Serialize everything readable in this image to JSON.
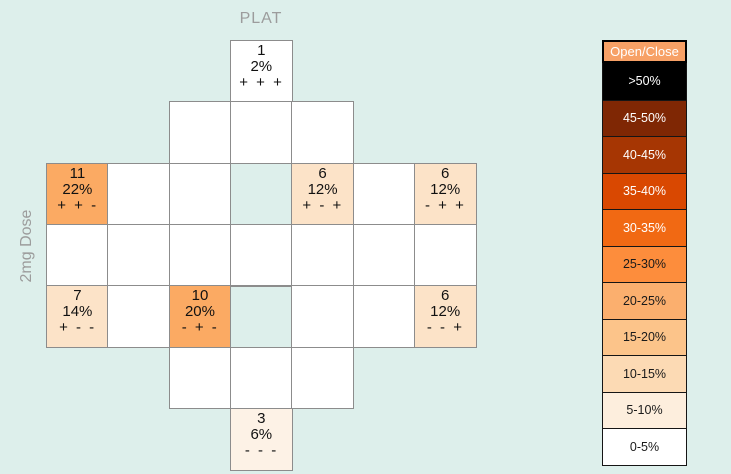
{
  "background_color": "#ddefeb",
  "grid_border_color": "#8c8c8c",
  "labels": {
    "top_axis": "PLAT",
    "left_axis": "2mg Dose"
  },
  "chart_data": {
    "type": "heatmap",
    "title": "PLAT",
    "ylabel": "2mg Dose",
    "legend_position": "right",
    "legend_title": "Open/Close",
    "grid": {
      "rows": 7,
      "cols": 7,
      "origin_x": 46,
      "origin_y": 40,
      "cell_size": 61.3
    },
    "cells": [
      {
        "row": 0,
        "col": 3,
        "count": "1",
        "pct": "2%",
        "signs": "+ + +",
        "fill": "#ffffff"
      },
      {
        "row": 1,
        "col": 2,
        "fill": "#ffffff"
      },
      {
        "row": 1,
        "col": 3,
        "fill": "#ffffff"
      },
      {
        "row": 1,
        "col": 4,
        "fill": "#ffffff"
      },
      {
        "row": 2,
        "col": 0,
        "count": "11",
        "pct": "22%",
        "signs": "+ + -",
        "fill": "#fbaa63"
      },
      {
        "row": 2,
        "col": 1,
        "fill": "#ffffff"
      },
      {
        "row": 2,
        "col": 2,
        "fill": "#ffffff"
      },
      {
        "row": 2,
        "col": 3,
        "fill": "none"
      },
      {
        "row": 2,
        "col": 4,
        "count": "6",
        "pct": "12%",
        "signs": "+ - +",
        "fill": "#fce3c8"
      },
      {
        "row": 2,
        "col": 5,
        "fill": "#ffffff"
      },
      {
        "row": 2,
        "col": 6,
        "count": "6",
        "pct": "12%",
        "signs": "- + +",
        "fill": "#fce3c8"
      },
      {
        "row": 3,
        "col": 0,
        "fill": "#ffffff"
      },
      {
        "row": 3,
        "col": 1,
        "fill": "#ffffff"
      },
      {
        "row": 3,
        "col": 2,
        "fill": "#ffffff"
      },
      {
        "row": 3,
        "col": 3,
        "fill": "#ffffff"
      },
      {
        "row": 3,
        "col": 4,
        "fill": "#ffffff"
      },
      {
        "row": 3,
        "col": 5,
        "fill": "#ffffff"
      },
      {
        "row": 3,
        "col": 6,
        "fill": "#ffffff"
      },
      {
        "row": 4,
        "col": 0,
        "count": "7",
        "pct": "14%",
        "signs": "+ - -",
        "fill": "#fce3c8"
      },
      {
        "row": 4,
        "col": 1,
        "fill": "#ffffff"
      },
      {
        "row": 4,
        "col": 2,
        "count": "10",
        "pct": "20%",
        "signs": "- + -",
        "fill": "#fbaa63"
      },
      {
        "row": 4,
        "col": 3,
        "fill": "none"
      },
      {
        "row": 4,
        "col": 4,
        "fill": "#ffffff"
      },
      {
        "row": 4,
        "col": 5,
        "fill": "#ffffff"
      },
      {
        "row": 4,
        "col": 6,
        "count": "6",
        "pct": "12%",
        "signs": "- - +",
        "fill": "#fce3c8"
      },
      {
        "row": 5,
        "col": 2,
        "fill": "#ffffff"
      },
      {
        "row": 5,
        "col": 3,
        "fill": "#ffffff"
      },
      {
        "row": 5,
        "col": 4,
        "fill": "#ffffff"
      },
      {
        "row": 6,
        "col": 3,
        "count": "3",
        "pct": "6%",
        "signs": "- - -",
        "fill": "#fdf2e6"
      }
    ]
  },
  "legend": {
    "header": "Open/Close",
    "header_bg": "#f7a166",
    "items": [
      {
        "label": ">50%",
        "color": "#000000",
        "text_color": "#ffffff"
      },
      {
        "label": "45-50%",
        "color": "#7f2704",
        "text_color": "#ffffff"
      },
      {
        "label": "40-45%",
        "color": "#a63603",
        "text_color": "#ffffff"
      },
      {
        "label": "35-40%",
        "color": "#d94801",
        "text_color": "#ffffff"
      },
      {
        "label": "30-35%",
        "color": "#f16913",
        "text_color": "#ffffff"
      },
      {
        "label": "25-30%",
        "color": "#fd8d3c",
        "text_color": "#1a1a1a"
      },
      {
        "label": "20-25%",
        "color": "#fbaf6e",
        "text_color": "#1a1a1a"
      },
      {
        "label": "15-20%",
        "color": "#fcc48a",
        "text_color": "#1a1a1a"
      },
      {
        "label": "10-15%",
        "color": "#fcdab4",
        "text_color": "#1a1a1a"
      },
      {
        "label": "5-10%",
        "color": "#fdeedd",
        "text_color": "#1a1a1a"
      },
      {
        "label": "0-5%",
        "color": "#ffffff",
        "text_color": "#1a1a1a"
      }
    ]
  }
}
